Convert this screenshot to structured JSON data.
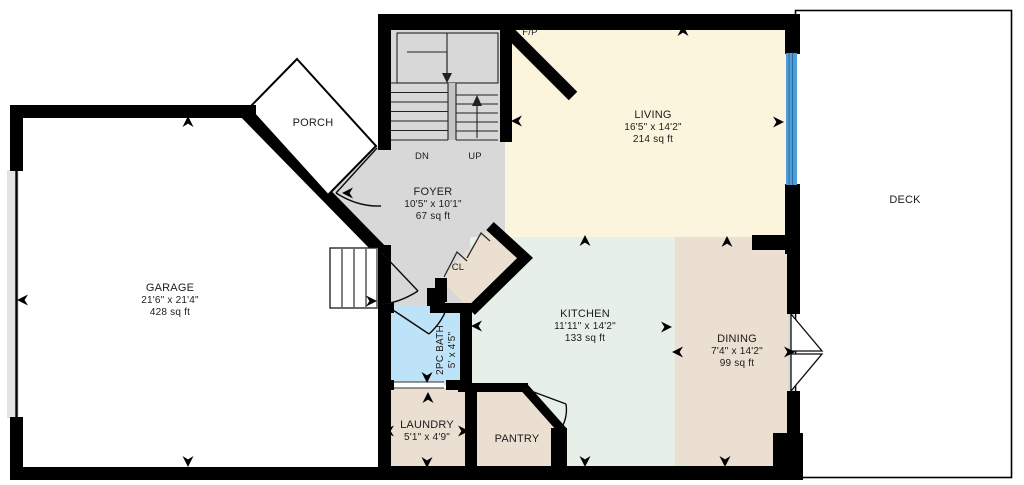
{
  "floorplan": {
    "rooms": {
      "garage": {
        "name": "GARAGE",
        "dims": "21'6\" x 21'4\"",
        "area": "428 sq ft"
      },
      "porch": {
        "name": "PORCH"
      },
      "foyer": {
        "name": "FOYER",
        "dims": "10'5\" x 10'1\"",
        "area": "67 sq ft"
      },
      "living": {
        "name": "LIVING",
        "dims": "16'5\" x 14'2\"",
        "area": "214 sq ft"
      },
      "deck": {
        "name": "DECK"
      },
      "kitchen": {
        "name": "KITCHEN",
        "dims": "11'11\" x 14'2\"",
        "area": "133 sq ft"
      },
      "dining": {
        "name": "DINING",
        "dims": "7'4\" x 14'2\"",
        "area": "99 sq ft"
      },
      "bath": {
        "name": "2PC BATH",
        "dims": "5' x 4'5\""
      },
      "laundry": {
        "name": "LAUNDRY",
        "dims": "5'1\" x 4'9\""
      },
      "pantry": {
        "name": "PANTRY"
      },
      "closet": {
        "name": "CL"
      },
      "fireplace": {
        "name": "F/P"
      }
    },
    "stairs": {
      "down_label": "DN",
      "up_label": "UP"
    },
    "colors": {
      "wall": "#000000",
      "foyer": "#d8d8d8",
      "living": "#fbf5dd",
      "kitchen": "#e7efe9",
      "dining": "#ebdfd1",
      "room_tan": "#eadfd0",
      "bath": "#bee2f7",
      "window": "#4d9ed6",
      "sill": "#d9d9d9",
      "garage_door_band": "#e3e3e3",
      "white": "#ffffff"
    }
  }
}
